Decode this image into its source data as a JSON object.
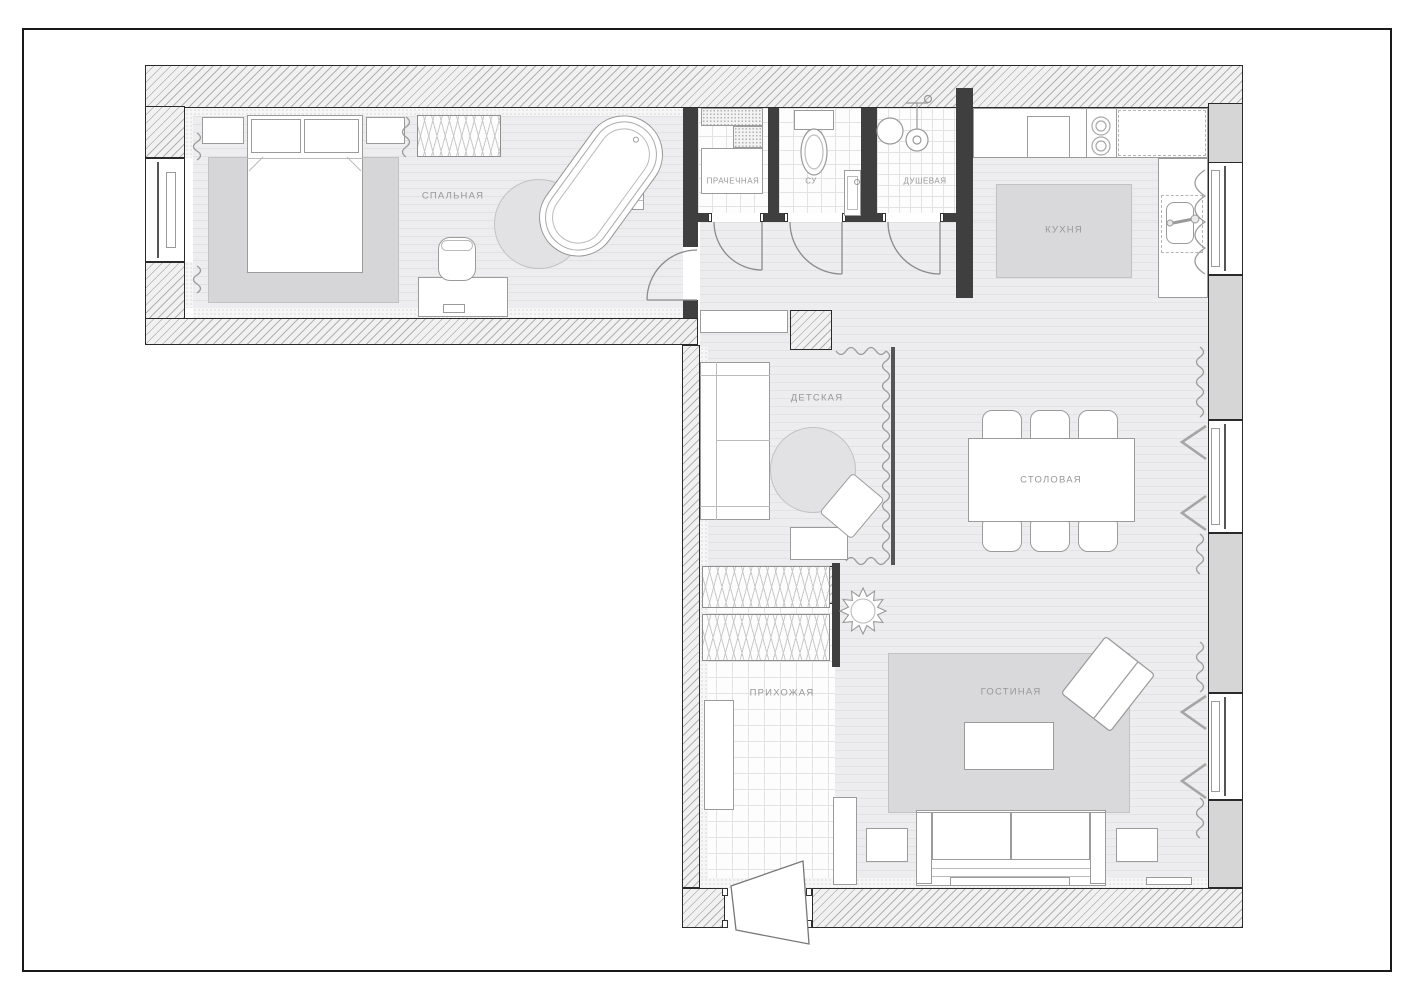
{
  "drawing": {
    "type": "apartment-floor-plan",
    "rooms": [
      {
        "id": "bedroom",
        "label": "СПАЛЬНАЯ"
      },
      {
        "id": "laundry",
        "label": "ПРАЧЕЧНАЯ"
      },
      {
        "id": "wc",
        "label": "СУ"
      },
      {
        "id": "shower",
        "label": "ДУШЕВАЯ"
      },
      {
        "id": "kitchen",
        "label": "КУХНЯ"
      },
      {
        "id": "kids-room",
        "label": "ДЕТСКАЯ"
      },
      {
        "id": "dining",
        "label": "СТОЛОВАЯ"
      },
      {
        "id": "hallway",
        "label": "ПРИХОЖАЯ"
      },
      {
        "id": "living",
        "label": "ГОСТИНАЯ"
      }
    ],
    "colors": {
      "paper": "#ffffff",
      "sheet_frame": "#1a1a1a",
      "wall_hatch": "#b1b1b1",
      "wall_fill": "#f1f1f1",
      "pilaster": "#d6d6d6",
      "partition": "#3f3f3f",
      "floor": "#ededef",
      "tile": "#fdfdfd",
      "rug": "#d9d9db",
      "furniture_line": "#9b9b9b",
      "label_text": "#979797"
    }
  }
}
